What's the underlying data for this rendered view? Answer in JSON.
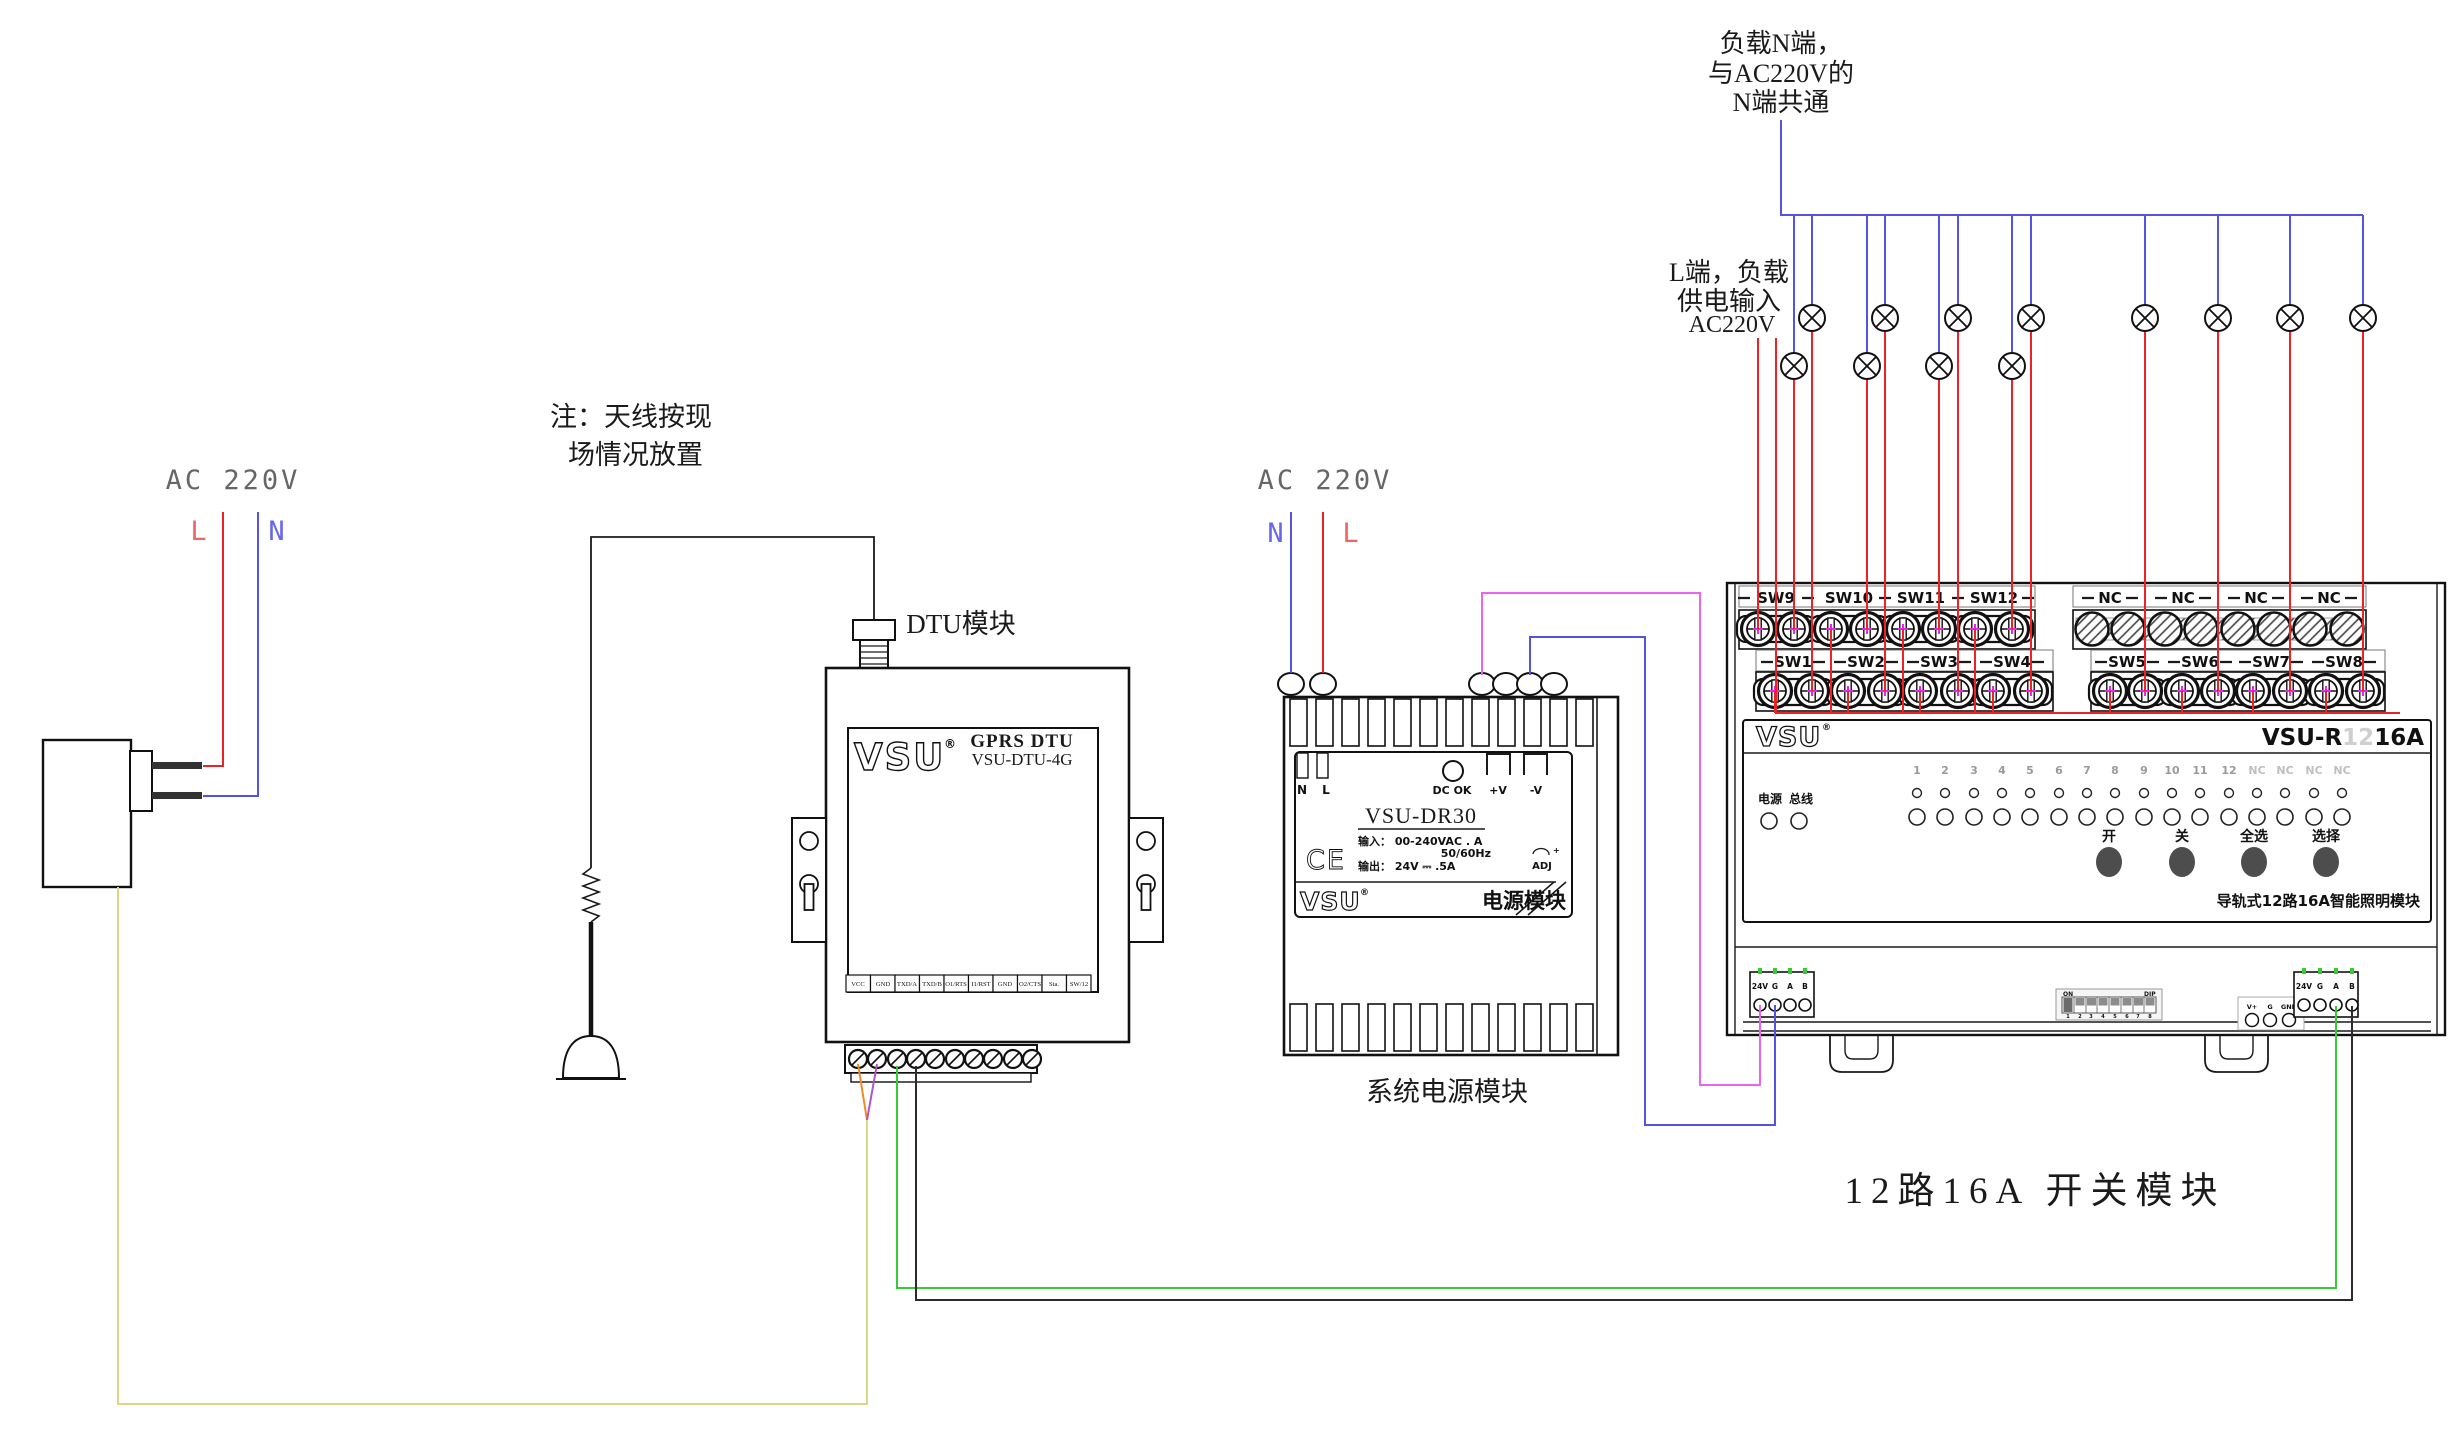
{
  "annotations": {
    "load_n_line1": "负载N端，",
    "load_n_line2": "与AC220V的",
    "load_n_line3": "N端共通",
    "load_l_line1": "L端，负载",
    "load_l_line2": "供电输入",
    "load_l_line3": "AC220V",
    "antenna_note_line1": "注：天线按现",
    "antenna_note_line2": "场情况放置",
    "bottom_title": "12路16A 开关模块"
  },
  "mains_left": {
    "label": "AC 220V",
    "live": "L",
    "neutral": "N"
  },
  "dtu": {
    "caption": "DTU模块",
    "brand": "VSU",
    "reg": "®",
    "product": "GPRS DTU",
    "model": "VSU-DTU-4G",
    "terminals": [
      "VCC",
      "GND",
      "TXD/A",
      "TXD/B",
      "O1/RTS",
      "I1/RST",
      "GND",
      "O2/CTS",
      "Sta.",
      "SW/12"
    ]
  },
  "power_module": {
    "ac_label": "AC 220V",
    "neutral": "N",
    "live": "L",
    "term_n": "N",
    "term_l": "L",
    "dc_ok": "DC OK",
    "v_plus": "+V",
    "v_minus": "-V",
    "model": "VSU-DR30",
    "input_line": "输入： 00-240VAC   . A",
    "freq_line": "50/60Hz",
    "output_line": "输出：   24V ⎓ .5A",
    "ce_mark": "CE",
    "adj": "ADJ",
    "brand": "VSU",
    "reg": "®",
    "panel_label": "电源模块",
    "caption": "系统电源模块"
  },
  "switch_module": {
    "brand": "VSU",
    "reg": "®",
    "model_prefix": "VSU-R",
    "model_channels": "12",
    "model_suffix": "16A",
    "led_power": "电源",
    "led_bus": "总线",
    "channel_labels": [
      "1",
      "2",
      "3",
      "4",
      "5",
      "6",
      "7",
      "8",
      "9",
      "10",
      "11",
      "12",
      "NC",
      "NC",
      "NC",
      "NC"
    ],
    "btn_on": "开",
    "btn_off": "关",
    "btn_select_all": "全选",
    "btn_select": "选择",
    "footer": "导轨式12路16A智能照明模块",
    "top_terminals": [
      "SW9",
      "SW10",
      "SW11",
      "SW12",
      "NC",
      "NC",
      "NC",
      "NC"
    ],
    "bottom_terminals": [
      "SW1",
      "SW2",
      "SW3",
      "SW4",
      "SW5",
      "SW6",
      "SW7",
      "SW8"
    ],
    "comm_left": [
      "24V",
      "G",
      "A",
      "B"
    ],
    "comm_right": [
      "24V",
      "G",
      "A",
      "B"
    ],
    "aux": [
      "V+",
      "G",
      "GND"
    ],
    "dip_on": "ON",
    "dip_name": "DIP",
    "dip_positions": [
      "1",
      "2",
      "3",
      "4",
      "5",
      "6",
      "7",
      "8"
    ]
  },
  "colors": {
    "wire_live": "#ee2222",
    "wire_neutral": "#5353e0",
    "wire_dc_plus": "#ee63ee",
    "wire_dc_minus": "#5353e0",
    "wire_bus_a": "#35cc35",
    "wire_bus_b": "#2b2b2b",
    "wire_adapter_dc": "#ddd688",
    "wire_vcc": "#f08a2a",
    "wire_gnd": "#b055c5",
    "label_muted": "#666666",
    "led_tick_green": "#33cc33"
  }
}
